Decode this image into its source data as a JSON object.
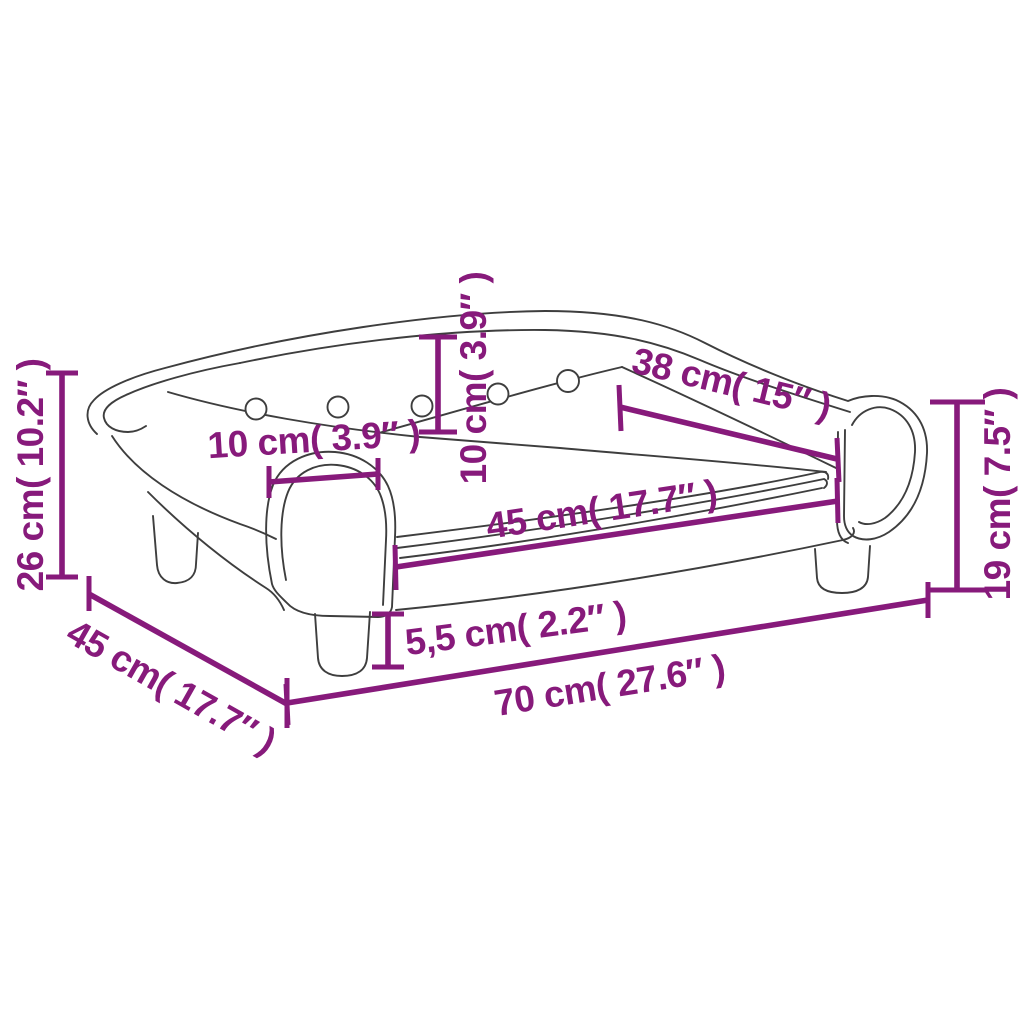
{
  "diagram": {
    "title": "Kids sofa dimension drawing",
    "colors": {
      "dimension_line": "#871A7B",
      "sofa_outline": "#3E3E3E",
      "background": "#FFFFFF"
    },
    "sofa": {
      "button_count": 5
    },
    "dimensions": [
      {
        "id": "back-height",
        "label": "26 cm( 10.2″ )"
      },
      {
        "id": "backrest-thickness",
        "label": "10 cm( 3.9″ )"
      },
      {
        "id": "armrest-width",
        "label": "10 cm( 3.9″ )"
      },
      {
        "id": "backrest-length",
        "label": "38 cm( 15″ )"
      },
      {
        "id": "seat-width",
        "label": "45 cm( 17.7″ )"
      },
      {
        "id": "armrest-height",
        "label": "19 cm( 7.5″ )"
      },
      {
        "id": "leg-height",
        "label": "5,5 cm( 2.2″ )"
      },
      {
        "id": "overall-width",
        "label": "70 cm( 27.6″ )"
      },
      {
        "id": "overall-depth",
        "label": "45 cm( 17.7″ )"
      }
    ]
  }
}
